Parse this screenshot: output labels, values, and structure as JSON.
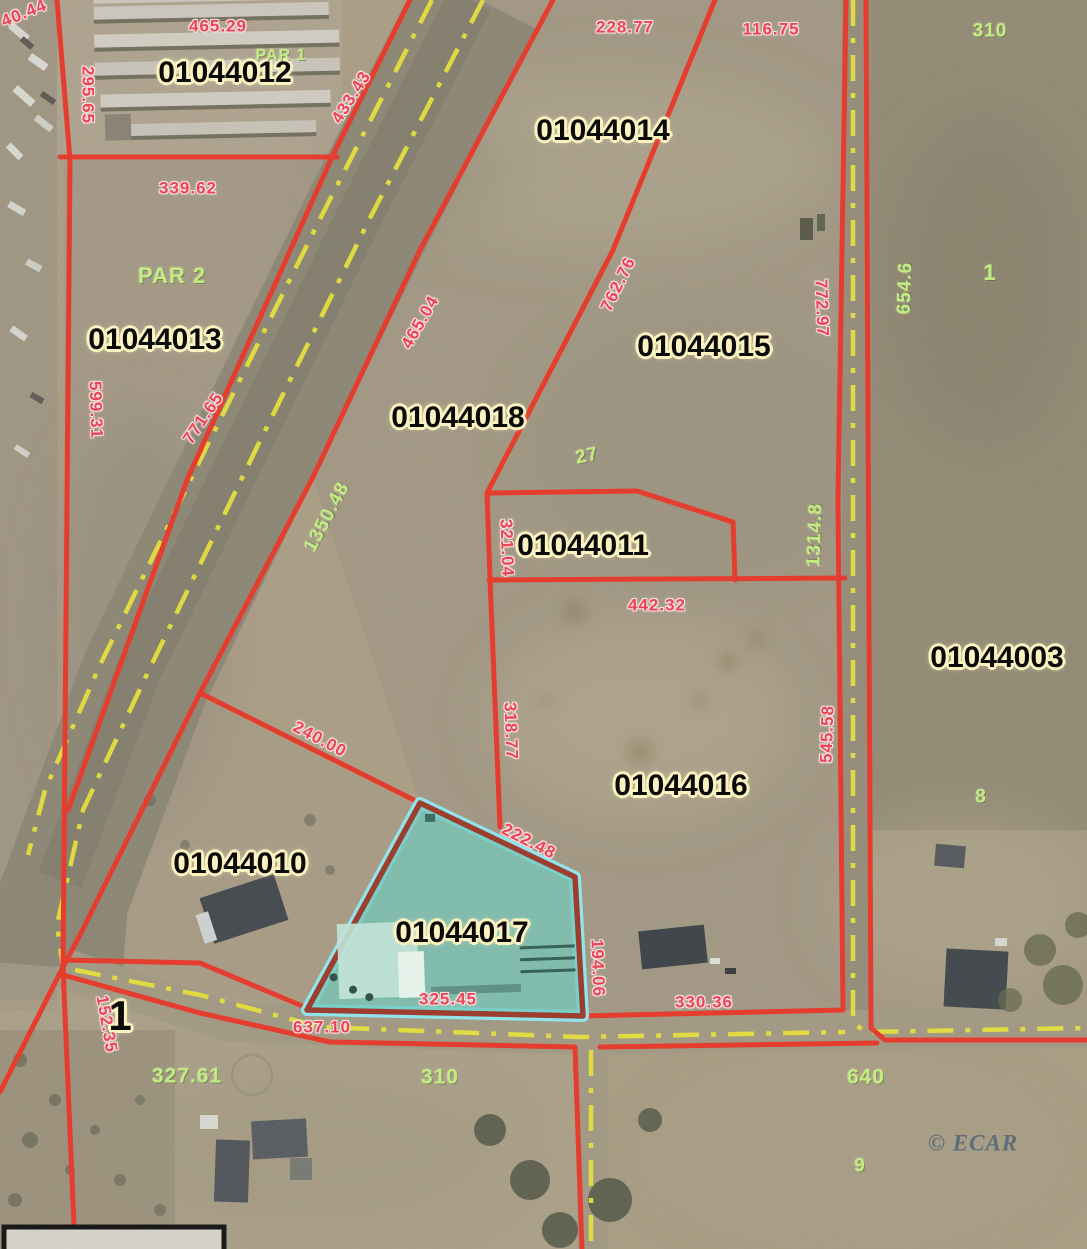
{
  "map": {
    "type": "parcel-aerial-map",
    "watermark": "© ECAR",
    "highlighted_parcel": "01044017",
    "colors": {
      "boundary_red": "#e8392b",
      "highlight_fill_teal": "#6fc9bd",
      "highlight_outline_cyan": "#8fe8ef",
      "highlight_border_maroon": "#9c3a2c",
      "road_centerline_yellow": "#e8e13c",
      "parcel_label_text": "#0b0b0b",
      "parcel_label_halo": "#fbf2c0",
      "dimension_red": "#ee4050",
      "dimension_green": "#c2ec82",
      "watermark_color": "#54687a"
    },
    "labels": [
      {
        "kind": "parcel",
        "text": "01044012",
        "x": 225,
        "y": 73
      },
      {
        "kind": "parcel",
        "text": "01044014",
        "x": 603,
        "y": 131
      },
      {
        "kind": "parcel",
        "text": "01044013",
        "x": 155,
        "y": 340
      },
      {
        "kind": "parcel",
        "text": "01044015",
        "x": 704,
        "y": 347
      },
      {
        "kind": "parcel",
        "text": "01044018",
        "x": 458,
        "y": 418
      },
      {
        "kind": "parcel",
        "text": "01044011",
        "x": 583,
        "y": 546
      },
      {
        "kind": "parcel",
        "text": "01044003",
        "x": 997,
        "y": 658
      },
      {
        "kind": "parcel",
        "text": "01044016",
        "x": 681,
        "y": 786
      },
      {
        "kind": "parcel",
        "text": "01044010",
        "x": 240,
        "y": 864
      },
      {
        "kind": "parcel",
        "text": "01044017",
        "x": 462,
        "y": 933
      },
      {
        "kind": "parcel",
        "text": "1",
        "x": 120,
        "y": 1016,
        "size": 42
      },
      {
        "kind": "red",
        "text": "40.44",
        "x": 24,
        "y": 13,
        "rot": -22
      },
      {
        "kind": "red",
        "text": "465.29",
        "x": 218,
        "y": 26
      },
      {
        "kind": "red",
        "text": "295.65",
        "x": 88,
        "y": 95,
        "rot": 90
      },
      {
        "kind": "red",
        "text": "433.43",
        "x": 351,
        "y": 97,
        "rot": -58
      },
      {
        "kind": "red",
        "text": "228.77",
        "x": 625,
        "y": 27
      },
      {
        "kind": "red",
        "text": "116.75",
        "x": 771,
        "y": 29
      },
      {
        "kind": "red",
        "text": "339.62",
        "x": 188,
        "y": 188
      },
      {
        "kind": "red",
        "text": "599.31",
        "x": 96,
        "y": 410,
        "rot": 88
      },
      {
        "kind": "red",
        "text": "771.65",
        "x": 203,
        "y": 418,
        "rot": -56
      },
      {
        "kind": "red",
        "text": "465.04",
        "x": 420,
        "y": 322,
        "rot": -60
      },
      {
        "kind": "red",
        "text": "762.76",
        "x": 618,
        "y": 284,
        "rot": -64
      },
      {
        "kind": "red",
        "text": "772.97",
        "x": 822,
        "y": 308,
        "rot": 88
      },
      {
        "kind": "red",
        "text": "321.04",
        "x": 507,
        "y": 548,
        "rot": 88
      },
      {
        "kind": "red",
        "text": "442.32",
        "x": 657,
        "y": 605
      },
      {
        "kind": "red",
        "text": "318.77",
        "x": 511,
        "y": 731,
        "rot": 88
      },
      {
        "kind": "red",
        "text": "545.58",
        "x": 827,
        "y": 734,
        "rot": -88
      },
      {
        "kind": "red",
        "text": "240.00",
        "x": 320,
        "y": 739,
        "rot": 28
      },
      {
        "kind": "red",
        "text": "222.48",
        "x": 529,
        "y": 841,
        "rot": 27
      },
      {
        "kind": "red",
        "text": "194.06",
        "x": 598,
        "y": 968,
        "rot": 88
      },
      {
        "kind": "red",
        "text": "330.36",
        "x": 704,
        "y": 1002
      },
      {
        "kind": "red",
        "text": "325.45",
        "x": 448,
        "y": 999
      },
      {
        "kind": "red",
        "text": "637.10",
        "x": 322,
        "y": 1027
      },
      {
        "kind": "red",
        "text": "152.35",
        "x": 107,
        "y": 1024,
        "rot": 80
      },
      {
        "kind": "green",
        "text": "PAR 1",
        "x": 281,
        "y": 56,
        "size": 16
      },
      {
        "kind": "green",
        "text": "310",
        "x": 990,
        "y": 31
      },
      {
        "kind": "green",
        "text": "654.6",
        "x": 905,
        "y": 288,
        "rot": -88
      },
      {
        "kind": "green",
        "text": "1",
        "x": 990,
        "y": 273,
        "size": 22
      },
      {
        "kind": "green",
        "text": "PAR 2",
        "x": 172,
        "y": 276,
        "size": 22
      },
      {
        "kind": "green",
        "text": "27",
        "x": 587,
        "y": 456,
        "rot": -12
      },
      {
        "kind": "green",
        "text": "1350.48",
        "x": 327,
        "y": 517,
        "rot": -62
      },
      {
        "kind": "green",
        "text": "1314.8",
        "x": 815,
        "y": 535,
        "rot": -88
      },
      {
        "kind": "green",
        "text": "8",
        "x": 981,
        "y": 797
      },
      {
        "kind": "green",
        "text": "327.61",
        "x": 187,
        "y": 1076,
        "size": 21
      },
      {
        "kind": "green",
        "text": "310",
        "x": 440,
        "y": 1077,
        "size": 21
      },
      {
        "kind": "green",
        "text": "640",
        "x": 866,
        "y": 1077,
        "size": 21
      },
      {
        "kind": "green",
        "text": "9",
        "x": 860,
        "y": 1166
      },
      {
        "kind": "wm",
        "text": "© ECAR",
        "x": 973,
        "y": 1143
      }
    ]
  }
}
